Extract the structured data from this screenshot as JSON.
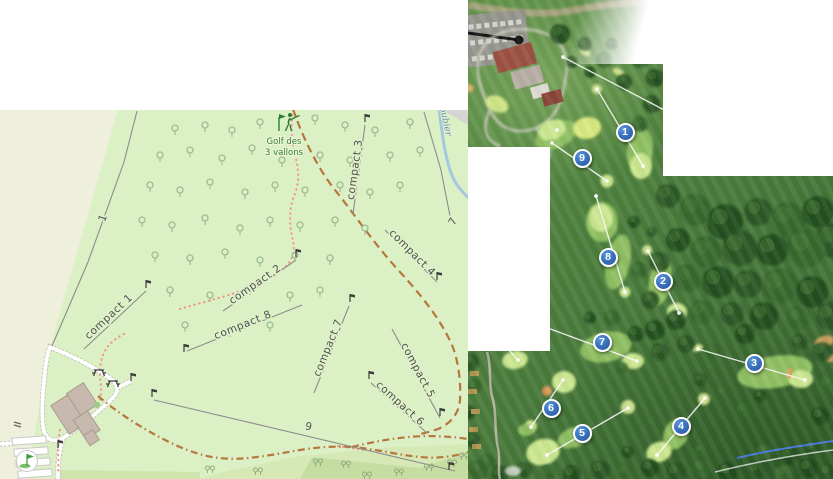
{
  "left_map": {
    "course_label": {
      "line1": "Golf des",
      "line2": "3 vallons"
    },
    "stream_label": "oubier",
    "routes": [
      {
        "label": "compact 1"
      },
      {
        "label": "compact 2"
      },
      {
        "label": "compact 3"
      },
      {
        "label": "compact 4"
      },
      {
        "label": "compact 5"
      },
      {
        "label": "compact 6"
      },
      {
        "label": "compact 7"
      },
      {
        "label": "compact 8"
      }
    ],
    "misc": {
      "one": "1",
      "nine": "9",
      "seven": "7"
    }
  },
  "right_map": {
    "holes": [
      {
        "number": "1"
      },
      {
        "number": "2"
      },
      {
        "number": "3"
      },
      {
        "number": "4"
      },
      {
        "number": "5"
      },
      {
        "number": "6"
      },
      {
        "number": "7"
      },
      {
        "number": "8"
      },
      {
        "number": "9"
      }
    ]
  },
  "colors": {
    "farmland": "#eff0dc",
    "golf_green": "#dcf0c5",
    "route_line": "#8c8c8c",
    "dashed_track": "#b5773d",
    "dotted_path": "#f2918c",
    "stream": "#a5c8e1",
    "water_label": "#6d92b4",
    "course_label": "#3f7d3f",
    "building": "#c7b9ad",
    "aerial_fairway": "#8fbf62",
    "aerial_green": "#cbe790",
    "marker_blue_dark": "#255296",
    "marker_blue_light": "#5b96d8"
  }
}
